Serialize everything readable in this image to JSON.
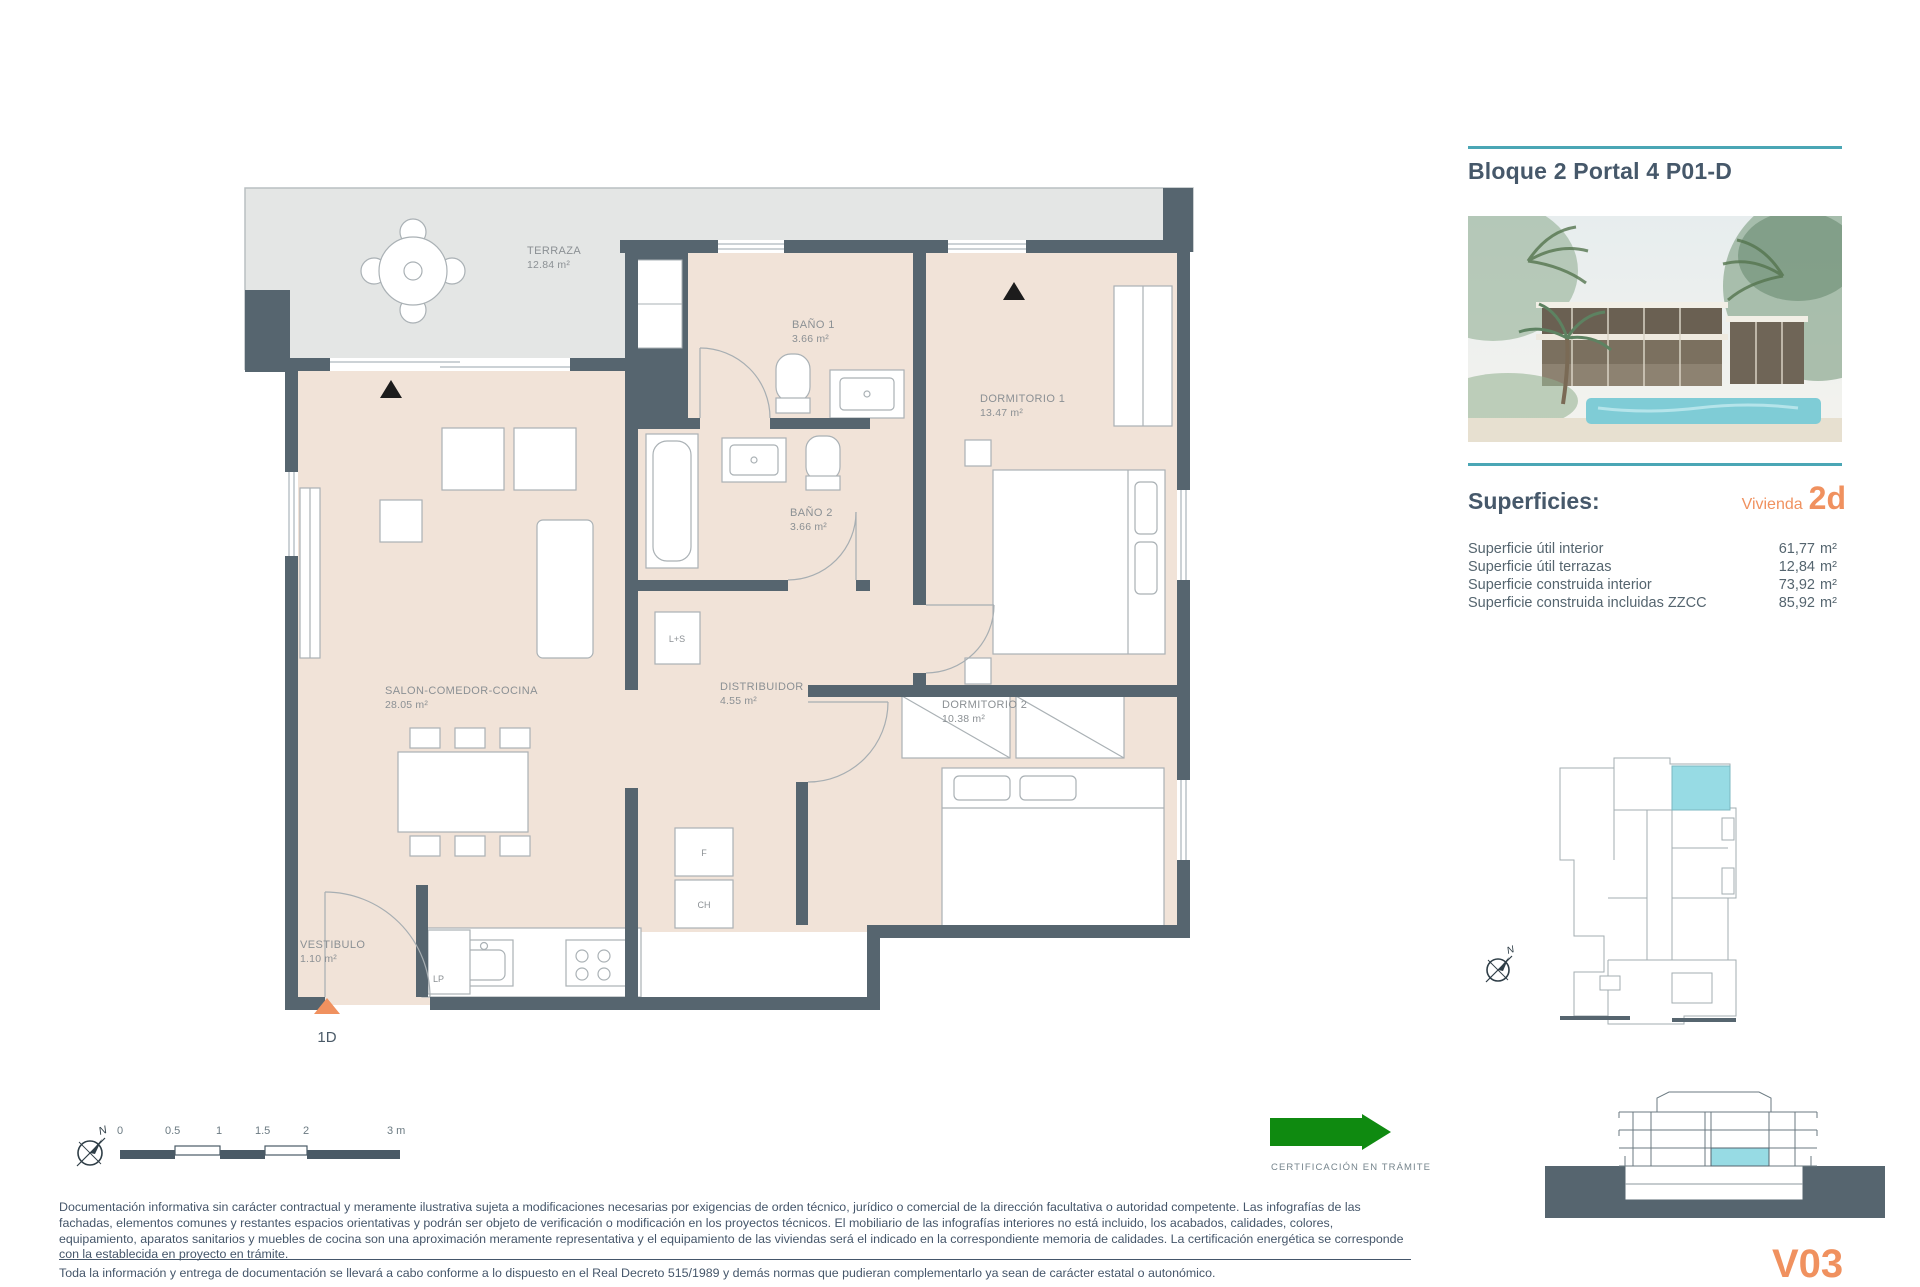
{
  "header": {
    "title": "Bloque 2 Portal 4 P01-D"
  },
  "superficies": {
    "heading": "Superficies:",
    "vivienda_label": "Vivienda",
    "vivienda_code": "2d",
    "rows": [
      {
        "label": "Superficie útil interior",
        "value": "61,77",
        "unit": "m²"
      },
      {
        "label": "Superficie útil terrazas",
        "value": "12,84",
        "unit": "m²"
      },
      {
        "label": "Superficie construida interior",
        "value": "73,92",
        "unit": "m²"
      },
      {
        "label": "Superficie construida incluidas ZZCC",
        "value": "85,92",
        "unit": "m²"
      }
    ]
  },
  "plan": {
    "rooms": [
      {
        "name": "TERRAZA",
        "area": "12.84 m²"
      },
      {
        "name": "BAÑO 1",
        "area": "3.66 m²"
      },
      {
        "name": "DORMITORIO 1",
        "area": "13.47 m²"
      },
      {
        "name": "BAÑO 2",
        "area": "3.66 m²"
      },
      {
        "name": "SALON-COMEDOR-COCINA",
        "area": "28.05 m²"
      },
      {
        "name": "DISTRIBUIDOR",
        "area": "4.55 m²"
      },
      {
        "name": "DORMITORIO 2",
        "area": "10.38 m²"
      },
      {
        "name": "VESTIBULO",
        "area": "1.10 m²"
      }
    ],
    "closets": {
      "ls": "L+S",
      "f": "F",
      "ch": "CH",
      "lp": "LP"
    },
    "unit_marker": "1D",
    "north_letter": "N"
  },
  "scalebar": {
    "ticks": [
      "0",
      "0.5",
      "1",
      "1.5",
      "2",
      "3 m"
    ]
  },
  "certification": {
    "label": "CERTIFICACIÓN EN TRÁMITE"
  },
  "legal": {
    "para1": "Documentación informativa sin carácter contractual y meramente ilustrativa sujeta a modificaciones necesarias por exigencias de orden técnico, jurídico o comercial de la dirección facultativa o autoridad competente. Las infografías de las fachadas, elementos comunes y restantes espacios orientativas y podrán ser objeto de verificación o modificación en los proyectos técnicos. El mobiliario de las infografías interiores no está incluido, los acabados, calidades, colores, equipamiento, aparatos sanitarios y muebles de cocina son una aproximación meramente representativa y el equipamiento de las viviendas será el indicado en la correspondiente memoria de calidades. La certificación energética se corresponde con la establecida en proyecto en trámite.",
    "para2": "Toda la información y entrega de documentación se llevará a cabo conforme a lo dispuesto en el Real Decreto 515/1989 y demás normas que pudieran complementarlo ya sean de carácter estatal o autonómico."
  },
  "version": "V03",
  "colors": {
    "accent_teal": "#4aa6b5",
    "accent_orange": "#f0915f",
    "wall": "#56656f",
    "interior": "#f1e3d8",
    "terrace": "#e4e6e5",
    "highlight": "#97dbe4",
    "cert_green": "#0f8a10"
  }
}
